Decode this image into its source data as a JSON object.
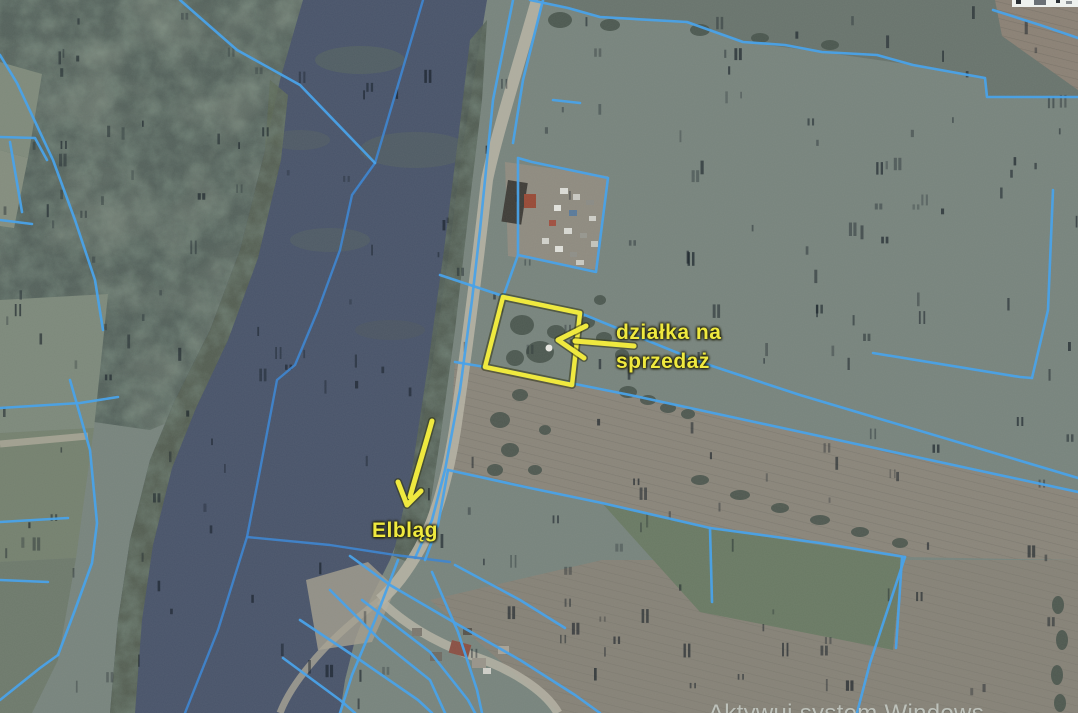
{
  "map": {
    "type": "aerial-cadastral-map",
    "annotations": {
      "parcel": {
        "line1": "działka na",
        "line2": "sprzedaż"
      },
      "city": {
        "label": "Elbląg"
      }
    },
    "watermark": {
      "text": "Aktywuj system Windows"
    },
    "colors": {
      "cadastral_line": "#4aa2e8",
      "annotation_yellow": "#efe93f",
      "river_water": "#49546a",
      "field_green": "#78847d",
      "field_brown": "#8a857a",
      "forest_green": "#55625c",
      "road_gray": "#b5b1a3"
    }
  }
}
